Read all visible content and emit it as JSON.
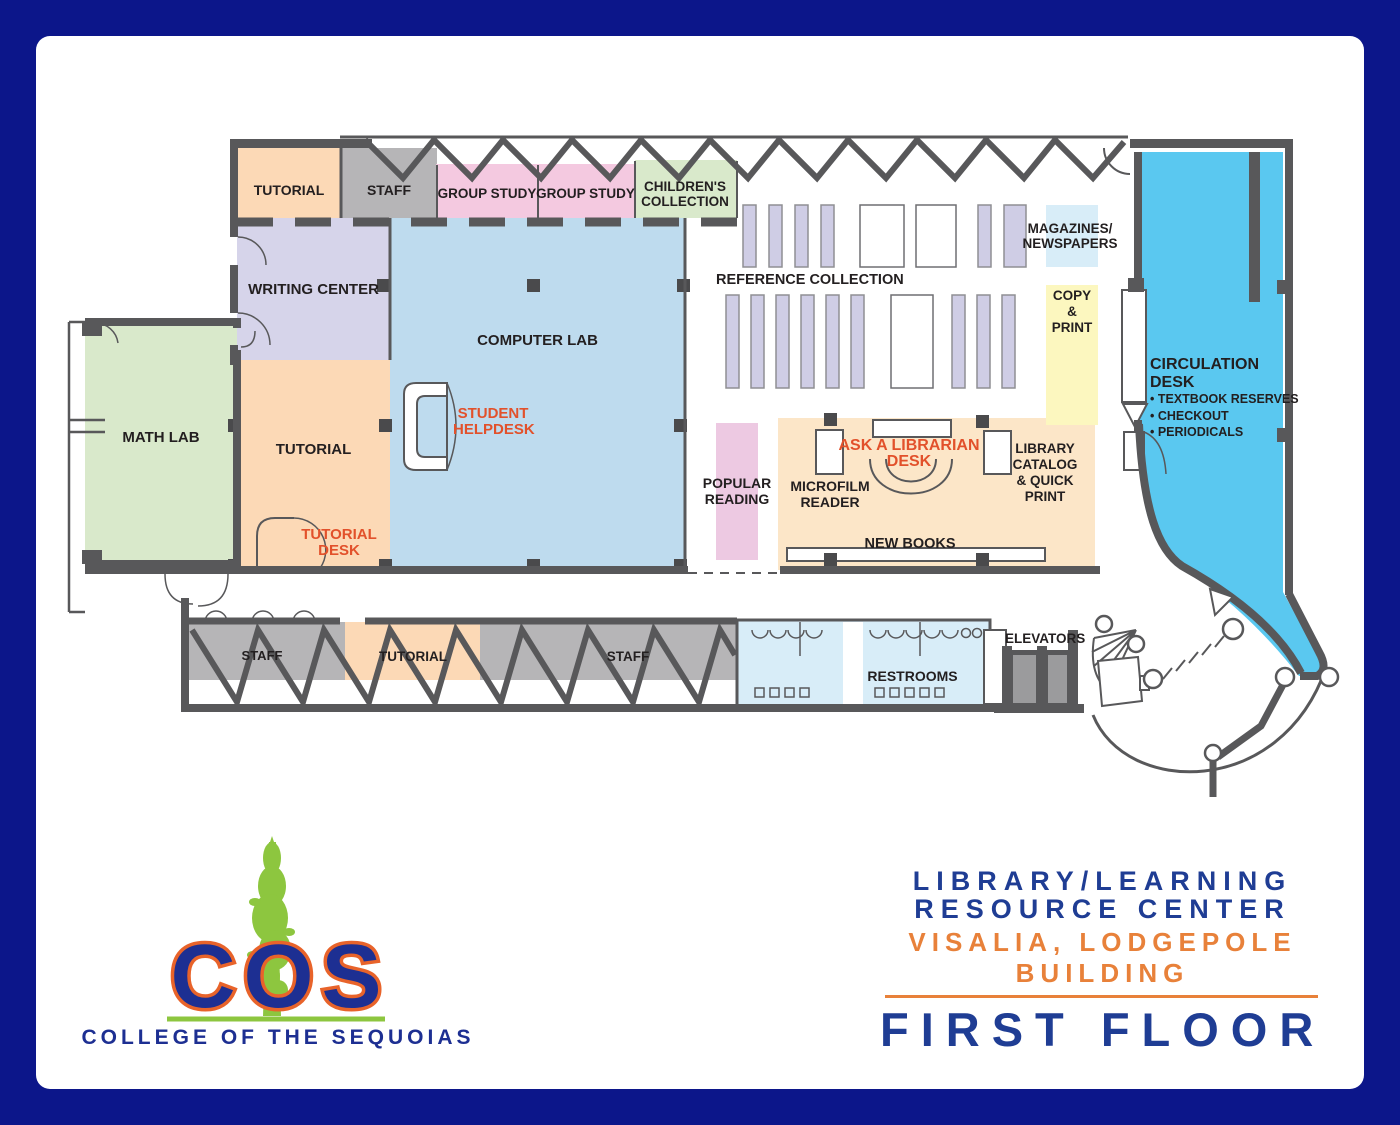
{
  "colors": {
    "frame_navy": "#0c168a",
    "wall_gray": "#58585a",
    "room_orange": "#fcd9b6",
    "room_gray": "#b6b5b7",
    "room_pink": "#f4c9e0",
    "room_green": "#d9e9cb",
    "room_lavender": "#d6d4ea",
    "computer_lab_blue": "#bedbee",
    "circulation_cyan": "#5ac8f0",
    "restroom_blue": "#d8edf8",
    "copy_yellow": "#fcf7bf",
    "new_books_peach": "#fce6c8",
    "popular_pink": "#edc9e2",
    "shelf_lavender": "#cfcde5",
    "accent_orange_text": "#e2512b",
    "title_navy": "#1f3d94",
    "title_orange": "#e8813a",
    "logo_green": "#8dc63f",
    "logo_navy": "#1d2f92",
    "logo_outline_orange": "#e8632a"
  },
  "rooms": {
    "tutorial_top": "TUTORIAL",
    "staff_top": "STAFF",
    "group_study_a": "GROUP STUDY",
    "group_study_b": "GROUP STUDY",
    "childrens_collection": [
      "CHILDREN'S",
      "COLLECTION"
    ],
    "writing_center": "WRITING CENTER",
    "computer_lab": "COMPUTER LAB",
    "math_lab": "MATH LAB",
    "tutorial_main": "TUTORIAL",
    "staff_bottom_left": "STAFF",
    "tutorial_bottom": "TUTORIAL",
    "staff_bottom_right": "STAFF",
    "restrooms": "RESTROOMS",
    "elevators": "ELEVATORS"
  },
  "areas": {
    "reference_collection": "REFERENCE COLLECTION",
    "magazines": [
      "MAGAZINES/",
      "NEWSPAPERS"
    ],
    "copy_print": [
      "COPY",
      "&",
      "PRINT"
    ],
    "popular_reading": [
      "POPULAR",
      "READING"
    ],
    "microfilm_reader": [
      "MICROFILM",
      "READER"
    ],
    "new_books": "NEW BOOKS",
    "library_catalog": [
      "LIBRARY",
      "CATALOG",
      "& QUICK",
      "PRINT"
    ]
  },
  "desks": {
    "student_helpdesk": [
      "STUDENT",
      "HELPDESK"
    ],
    "tutorial_desk": [
      "TUTORIAL",
      "DESK"
    ],
    "ask_librarian": [
      "ASK A LIBRARIAN",
      "DESK"
    ],
    "circulation": {
      "title": "CIRCULATION DESK",
      "items": [
        "• TEXTBOOK RESERVES",
        "• CHECKOUT",
        "• PERIODICALS"
      ]
    }
  },
  "logo": {
    "acronym": "COS",
    "name": "COLLEGE OF THE SEQUOIAS"
  },
  "title_block": {
    "line1": "LIBRARY/LEARNING",
    "line2": "RESOURCE CENTER",
    "line3": "VISALIA, LODGEPOLE",
    "line4": "BUILDING",
    "floor": "FIRST FLOOR"
  }
}
